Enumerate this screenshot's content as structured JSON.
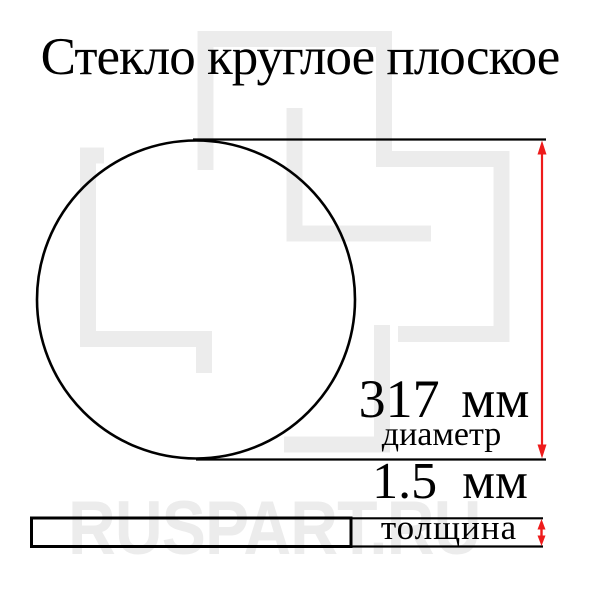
{
  "title": "Стекло круглое плоское",
  "dimensions": {
    "diameter": {
      "value": "317 мм",
      "label": "диаметр"
    },
    "thickness": {
      "value": "1.5 мм",
      "label": "толщина"
    }
  },
  "watermark": {
    "text": "RUSPART.RU"
  },
  "colors": {
    "arrow_red": "#ee1b1b",
    "drawing_black": "#000000",
    "watermark_gray": "#ececec"
  }
}
